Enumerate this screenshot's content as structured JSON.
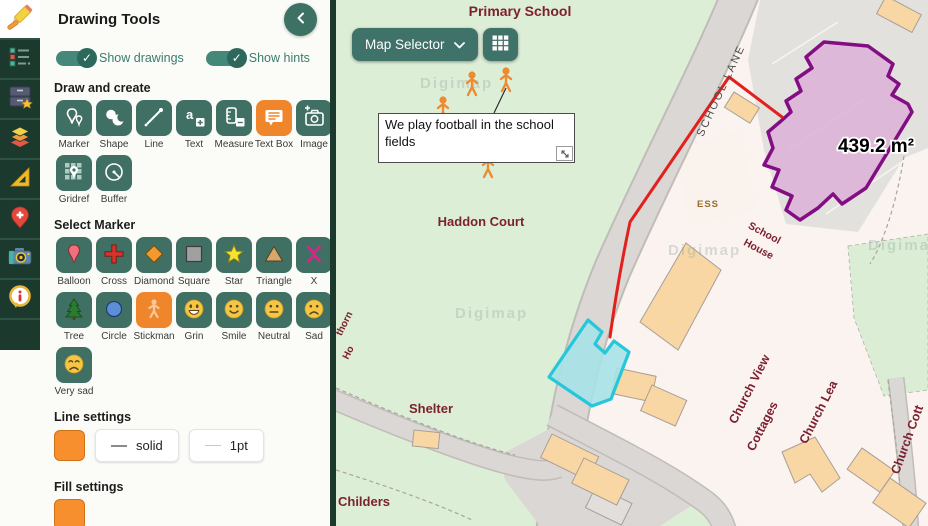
{
  "panel": {
    "title": "Drawing Tools",
    "toggles": [
      {
        "label": "Show drawings",
        "on": true
      },
      {
        "label": "Show hints",
        "on": true
      }
    ],
    "section_labels": {
      "draw_create": "Draw and create",
      "select_marker": "Select Marker",
      "line_settings": "Line settings",
      "fill_settings": "Fill settings"
    },
    "draw_tools": [
      {
        "label": "Marker",
        "icon": "marker-icon",
        "active": false
      },
      {
        "label": "Shape",
        "icon": "shape-icon",
        "active": false
      },
      {
        "label": "Line",
        "icon": "line-icon",
        "active": false
      },
      {
        "label": "Text",
        "icon": "text-icon",
        "active": false
      },
      {
        "label": "Measure",
        "icon": "measure-icon",
        "active": false
      },
      {
        "label": "Text Box",
        "icon": "text-box-icon",
        "active": true
      },
      {
        "label": "Image",
        "icon": "image-icon",
        "active": false
      },
      {
        "label": "Gridref",
        "icon": "gridref-icon",
        "active": false
      },
      {
        "label": "Buffer",
        "icon": "buffer-icon",
        "active": false
      }
    ],
    "markers": [
      {
        "label": "Balloon",
        "active": false
      },
      {
        "label": "Cross",
        "active": false
      },
      {
        "label": "Diamond",
        "active": false
      },
      {
        "label": "Square",
        "active": false
      },
      {
        "label": "Star",
        "active": false
      },
      {
        "label": "Triangle",
        "active": false
      },
      {
        "label": "X",
        "active": false
      },
      {
        "label": "Tree",
        "active": false
      },
      {
        "label": "Circle",
        "active": false
      },
      {
        "label": "Stickman",
        "active": true
      },
      {
        "label": "Grin",
        "active": false
      },
      {
        "label": "Smile",
        "active": false
      },
      {
        "label": "Neutral",
        "active": false
      },
      {
        "label": "Sad",
        "active": false
      },
      {
        "label": "Very sad",
        "active": false
      }
    ],
    "line_settings": {
      "color": "#f78f2e",
      "style": "solid",
      "width": "1pt"
    },
    "fill_settings": {
      "color": "#f78f2e"
    }
  },
  "rail": {
    "icons": [
      "pencil-icon",
      "legend-icon",
      "saved-maps-icon",
      "layers-icon",
      "set-square-icon",
      "map-pin-icon",
      "camera-icon",
      "info-icon"
    ]
  },
  "map": {
    "controls": {
      "map_selector_label": "Map Selector",
      "grid_button_icon": "grid-icon"
    },
    "textbox": {
      "text": "We play football in the school fields"
    },
    "area_label": "439.2 m²",
    "watermark": "Digimap",
    "labels": {
      "primary_school": "Primary School",
      "school_lane": "SCHOOL LANE",
      "ess": "ESS",
      "haddon_court": "Haddon Court",
      "school_house_1": "School",
      "school_house_2": "House",
      "church_view": "Church View",
      "cottages": "Cottages",
      "church_lea": "Church Lea",
      "church_cott": "Church Cott",
      "shelter": "Shelter",
      "childers": "Childers",
      "thorn": "thorn",
      "ho": "Ho"
    },
    "colors": {
      "field_green": "#ddeed7",
      "built_area": "#faf3ef",
      "road": "#d9d6d3",
      "building_orange": "#f8d7a5",
      "annotation_red": "#e3201b",
      "annotation_cyan_stroke": "#25c7da",
      "annotation_cyan_fill": "#a6e2e8",
      "annotation_purple_stroke": "#830d83",
      "annotation_purple_fill": "#dcaed8",
      "stickman_orange": "#ee8a30"
    }
  }
}
